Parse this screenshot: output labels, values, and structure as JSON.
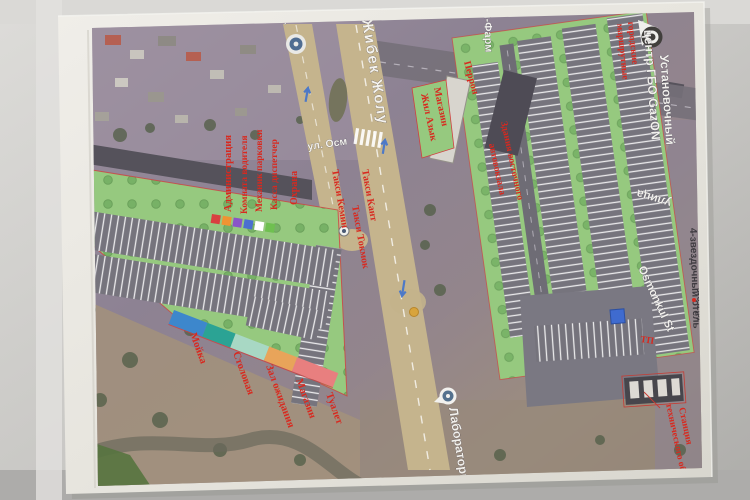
{
  "roads": {
    "main_avenue": "Жибек Жолу",
    "main_avenue_lower": "Лаборатория",
    "side_street": "ул. Осм",
    "side_street_fragment": "ул",
    "right_street": "улица",
    "right_street_latin": "Osmonkul St",
    "left_edge_street_fragment": "итина"
  },
  "places": {
    "pharmacy": "н-Фарм",
    "gazon_line1": "Установочный",
    "gazon_line2": "центр ГБО GazON",
    "city_routes_line1": "городские",
    "city_routes_line2": "маршрутные",
    "hotel": "4-звездочный отель",
    "hotel_number": "378 в (5)"
  },
  "labels": {
    "shop_green_line1": "Магазин",
    "shop_green_line2": "Жил Азык",
    "perron": "Перрон",
    "bus_station_line1": "Здания восточного",
    "bus_station_line2": "автовокзала",
    "admin": "Администрация",
    "driver_room": "Комната водителя",
    "mechanic": "Механик парковки",
    "cashier": "Касса диспетчер",
    "security_building": "Охрана",
    "security_edge": "Охрана",
    "taxi_kemin": "Такси Кемин",
    "taxi_tokmok": "Такси Токмок",
    "taxi_kant": "Такси Кант",
    "car_wash": "Мойка",
    "canteen": "Столовая",
    "waiting_hall": "Зал ожидания",
    "shop_small": "Магазин",
    "toilet": "Туалет",
    "sto_line1": "Станция",
    "sto_line2": "технического обслуживания",
    "tp": "ТП"
  },
  "colors": {
    "wash": "#3d87cc",
    "canteen": "#2ba394",
    "waiting": "#a8d8c4",
    "shop": "#e8a45a",
    "toilet": "#e87f7f",
    "sq1": "#d84040",
    "sq2": "#ef9432",
    "sq3": "#8a55c8",
    "sq4": "#4a6fd0",
    "sq5": "#ffffff",
    "sq6": "#6fc050",
    "green": "#96c97f",
    "asphalt": "#76747d",
    "road_tan": "#c5b48d",
    "label_red": "#d8291f",
    "building": "#55525b",
    "blue_box": "#3f6bcf"
  }
}
